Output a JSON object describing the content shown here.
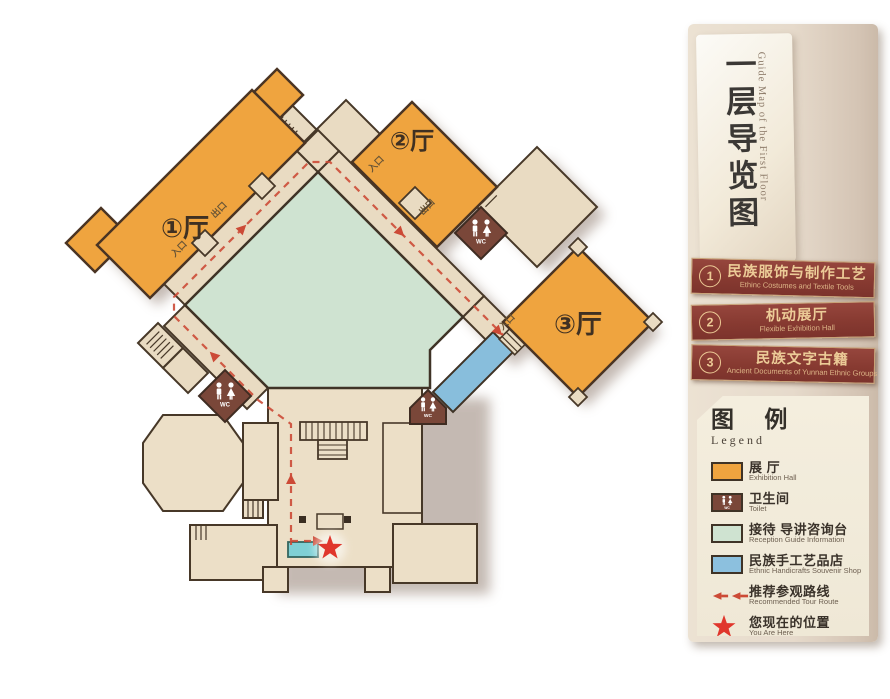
{
  "map": {
    "halls": [
      {
        "label": "①厅"
      },
      {
        "label": "②厅"
      },
      {
        "label": "③厅"
      }
    ],
    "entrance_label": "入口",
    "exit_label": "出口",
    "wc_label": "WC"
  },
  "panel": {
    "title_cn": "一层导览图",
    "title_en": "Guide Map of the First Floor",
    "items": [
      {
        "num": "1",
        "cn": "民族服饰与制作工艺",
        "en": "Ethinc Costumes and Textile Tools"
      },
      {
        "num": "2",
        "cn": "机动展厅",
        "en": "Flexible Exhibition Hall"
      },
      {
        "num": "3",
        "cn": "民族文字古籍",
        "en": "Ancient Documents of Yunnan Ethnic Groups"
      }
    ]
  },
  "legend": {
    "title_cn": "图 例",
    "title_en": "Legend",
    "entries": [
      {
        "cn": "展 厅",
        "en": "Exhibition Hall"
      },
      {
        "cn": "卫生间",
        "en": "Toilet"
      },
      {
        "cn": "接待 导讲咨询台",
        "en": "Reception Guide Information"
      },
      {
        "cn": "民族手工艺品店",
        "en": "Ethnic Handicrafts Souvenir Shop"
      },
      {
        "cn": "推荐参观路线",
        "en": "Recommended Tour Route"
      },
      {
        "cn": "您现在的位置",
        "en": "You Are Here"
      }
    ]
  },
  "colors": {
    "hall_orange": "#efa43f",
    "courtyard_green": "#cfe3d1",
    "floor_beige": "#e9dbc2",
    "lobby_beige": "#ecdfc7",
    "wc_brown": "#7a4739",
    "shop_blue": "#88bedc",
    "counter_teal": "#7fd0d5",
    "route_red": "#cc4a36",
    "star_red": "#e0362c",
    "bar_maroon": "#8c3e36",
    "bar_gold": "#eccb97"
  }
}
